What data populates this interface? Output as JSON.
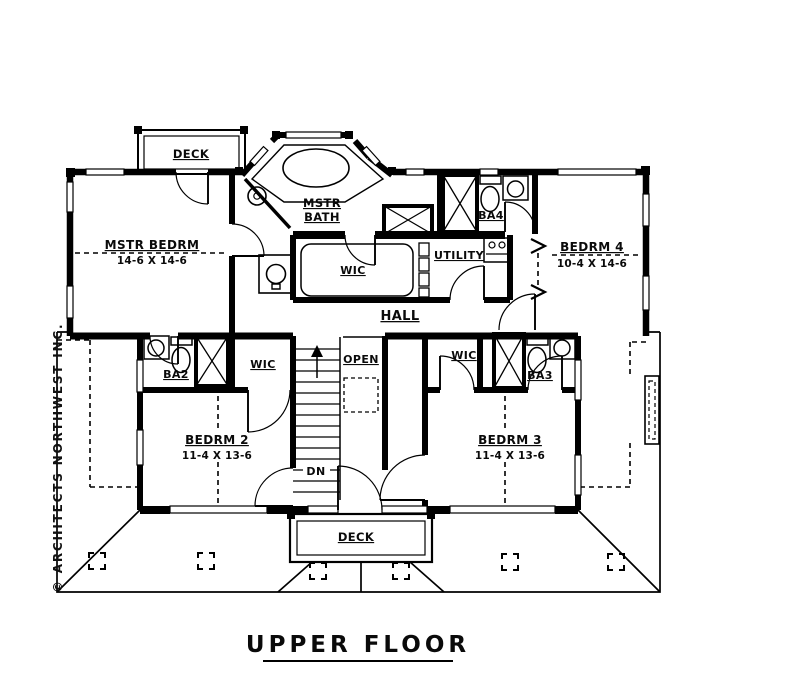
{
  "drawing": {
    "title": "UPPER FLOOR",
    "copyright": "© ARCHITECTS NORTHWEST INC.",
    "colors": {
      "ink": "#000000",
      "paper": "#ffffff"
    },
    "rooms": {
      "deck_top": {
        "label": "DECK"
      },
      "master_bedroom": {
        "label": "MSTR BEDRM",
        "dims": "14-6 X 14-6"
      },
      "master_bath": {
        "label_line1": "MSTR",
        "label_line2": "BATH"
      },
      "master_wic": {
        "label": "WIC"
      },
      "bath4": {
        "label": "BA4"
      },
      "bedroom4": {
        "label": "BEDRM 4",
        "dims": "10-4 X 14-6"
      },
      "utility": {
        "label": "UTILITY"
      },
      "hall": {
        "label": "HALL"
      },
      "wic2": {
        "label": "WIC"
      },
      "bath2": {
        "label": "BA2"
      },
      "bedroom2": {
        "label": "BEDRM 2",
        "dims": "11-4 X 13-6"
      },
      "stairs": {
        "open_label": "OPEN",
        "down_label": "DN"
      },
      "wic3": {
        "label": "WIC"
      },
      "bath3": {
        "label": "BA3"
      },
      "bedroom3": {
        "label": "BEDRM 3",
        "dims": "11-4 X 13-6"
      },
      "deck_bottom": {
        "label": "DECK"
      }
    }
  }
}
